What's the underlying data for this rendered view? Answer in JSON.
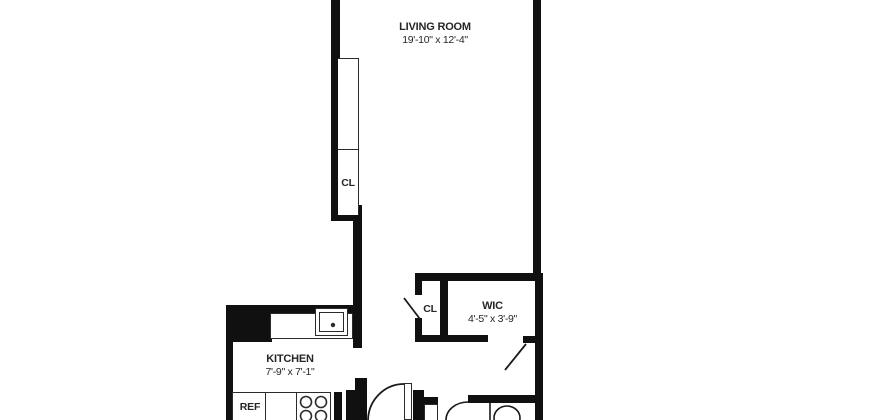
{
  "plan": {
    "type": "apartment-floor-plan",
    "background_color": "#ffffff",
    "wall_color": "#101010",
    "line_color": "#2b2b2b",
    "text_color": "#262626",
    "rooms": [
      {
        "id": "living-room",
        "name": "LIVING ROOM",
        "dimensions": "19'-10\" x 12'-4\""
      },
      {
        "id": "kitchen",
        "name": "KITCHEN",
        "dimensions": "7'-9\" x 7'-1\""
      },
      {
        "id": "wic",
        "name": "WIC",
        "dimensions": "4'-5\" x 3'-9\""
      },
      {
        "id": "closet-living-room",
        "name": "CL"
      },
      {
        "id": "closet-hall",
        "name": "CL"
      },
      {
        "id": "refrigerator",
        "name": "REF"
      }
    ],
    "fixtures": [
      "kitchen-sink",
      "kitchen-counter",
      "stove-4-burner",
      "refrigerator",
      "toilet",
      "bathtub-edge",
      "door-swing-hall",
      "door-swing-closet",
      "door-swing-wic"
    ]
  }
}
